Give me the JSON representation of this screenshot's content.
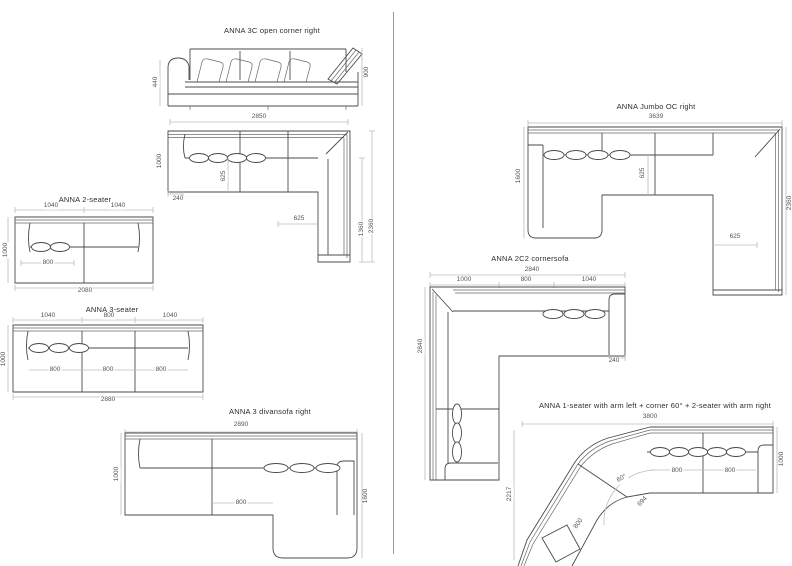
{
  "meta": {
    "sheet_type": "sofa dimension spec sheet",
    "line_color": "#4b4b4b",
    "dim_color": "#555555",
    "background": "#ffffff"
  },
  "d1": {
    "title": "ANNA 3C open corner right",
    "elev_height_left": "440",
    "elev_height_right": "900",
    "width_top": "2850",
    "depth_left": "1000",
    "seat_depth": "625",
    "front_left": "240",
    "corner_seat": "625",
    "right_inner": "1360",
    "right_total": "2360"
  },
  "d2": {
    "title": "ANNA 2-seater",
    "top_dims": [
      "1040",
      "1040"
    ],
    "depth_left": "1000",
    "seat_width": "800",
    "width_bottom": "2080"
  },
  "d3": {
    "title": "ANNA 3-seater",
    "top_dims": [
      "1040",
      "800",
      "1040"
    ],
    "depth_left": "1000",
    "seat_widths": [
      "800",
      "800",
      "800"
    ],
    "width_bottom": "2880"
  },
  "d4": {
    "title": "ANNA 3 divansofa right",
    "width_top": "2890",
    "depth_left": "1000",
    "seat_width": "800",
    "right_depth": "1600"
  },
  "d5": {
    "title": "ANNA Jumbo OC right",
    "width_top": "3639",
    "depth_left": "1600",
    "seat_depth": "625",
    "corner_seat": "625",
    "right_total": "2360"
  },
  "d6": {
    "title": "ANNA 2C2 cornersofa",
    "width_top": "2840",
    "top_dims": [
      "1000",
      "800",
      "1040"
    ],
    "arm_width": "240",
    "depth_left": "2840"
  },
  "d7": {
    "title": "ANNA 1-seater with arm left + corner 60° + 2-seater with arm right",
    "width_top": "3800",
    "right_depth": "1000",
    "seat_widths": [
      "800",
      "800"
    ],
    "corner_angle": "60°",
    "corner_width": "694",
    "angled_seat": "800",
    "left_depth": "2217"
  }
}
